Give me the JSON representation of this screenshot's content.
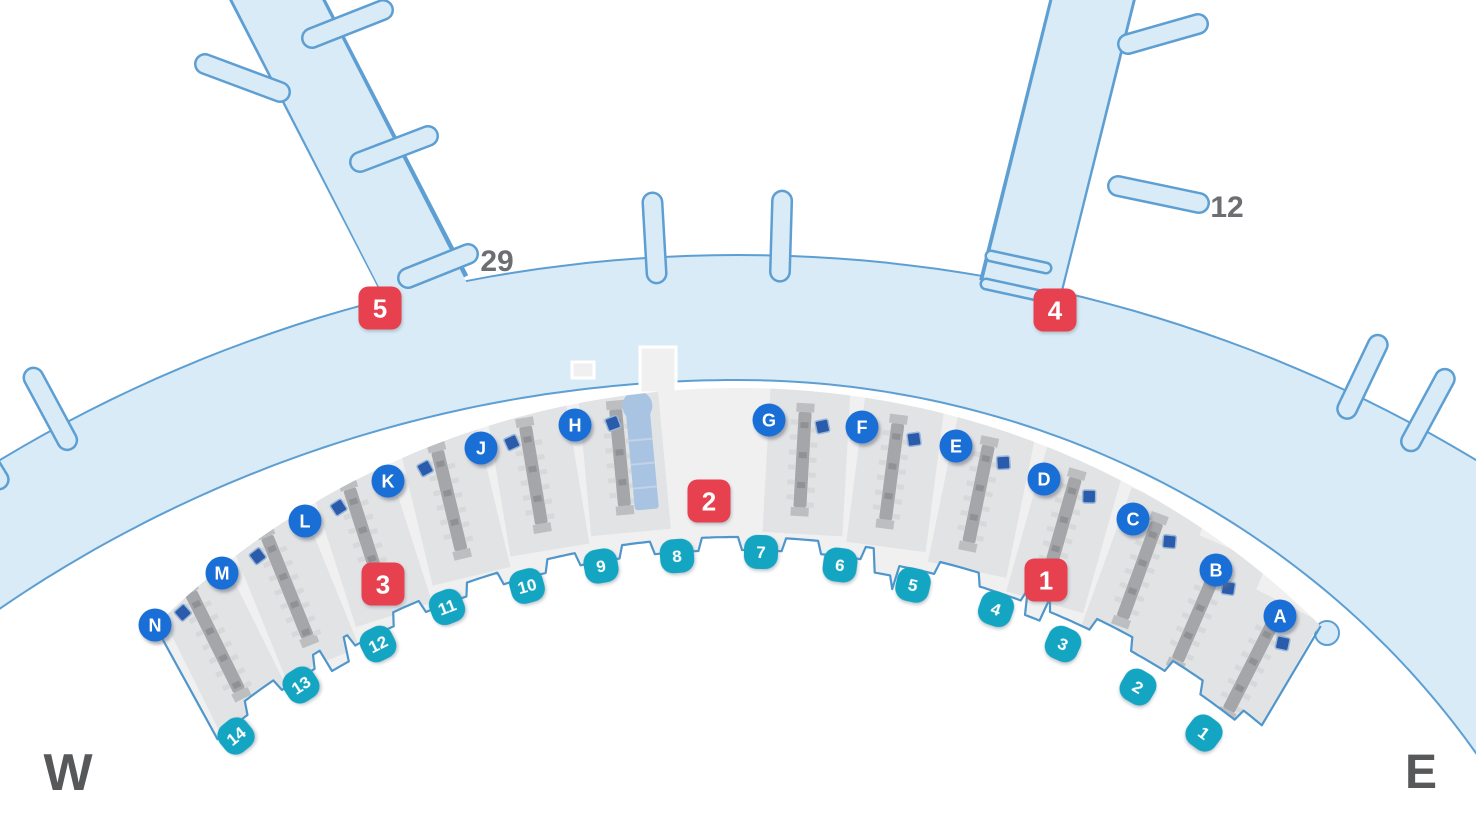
{
  "title": "Airport terminal level map",
  "compass": {
    "west": "W",
    "east": "E"
  },
  "pier_labels": [
    {
      "text": "29",
      "x": 497,
      "y": 271
    },
    {
      "text": "12",
      "x": 1227,
      "y": 217
    }
  ],
  "entrances": [
    {
      "label": "1",
      "x": 1046,
      "y": 580
    },
    {
      "label": "2",
      "x": 709,
      "y": 501
    },
    {
      "label": "3",
      "x": 383,
      "y": 584
    },
    {
      "label": "4",
      "x": 1055,
      "y": 310
    },
    {
      "label": "5",
      "x": 380,
      "y": 308
    }
  ],
  "checkin_counters": [
    {
      "letter": "A",
      "x": 1280,
      "y": 616,
      "theta": 26.9,
      "r": 1135,
      "h": 125
    },
    {
      "letter": "B",
      "x": 1216,
      "y": 570,
      "theta": 23.4,
      "r": 1160,
      "h": 128
    },
    {
      "letter": "C",
      "x": 1133,
      "y": 519,
      "theta": 20.0,
      "r": 1180,
      "h": 130
    },
    {
      "letter": "D",
      "x": 1044,
      "y": 479,
      "theta": 15.8,
      "r": 1198,
      "h": 128
    },
    {
      "letter": "E",
      "x": 956,
      "y": 446,
      "theta": 11.6,
      "r": 1210,
      "h": 126
    },
    {
      "letter": "F",
      "x": 862,
      "y": 427,
      "theta": 7.4,
      "r": 1218,
      "h": 124
    },
    {
      "letter": "G",
      "x": 769,
      "y": 420,
      "theta": 3.2,
      "r": 1222,
      "h": 122
    },
    {
      "letter": "H",
      "x": 575,
      "y": 425,
      "theta": -5.3,
      "r": 1228,
      "h": 124,
      "ramp": true
    },
    {
      "letter": "J",
      "x": 481,
      "y": 448,
      "theta": -9.4,
      "r": 1222,
      "h": 126
    },
    {
      "letter": "K",
      "x": 388,
      "y": 481,
      "theta": -13.5,
      "r": 1214,
      "h": 130
    },
    {
      "letter": "L",
      "x": 305,
      "y": 521,
      "theta": -17.8,
      "r": 1200,
      "h": 134
    },
    {
      "letter": "M",
      "x": 222,
      "y": 573,
      "theta": -22.1,
      "r": 1182,
      "h": 138
    },
    {
      "letter": "N",
      "x": 155,
      "y": 625,
      "theta": -26.4,
      "r": 1162,
      "h": 140
    }
  ],
  "doors": [
    {
      "label": "1",
      "x": 1204,
      "y": 733
    },
    {
      "label": "2",
      "x": 1138,
      "y": 687
    },
    {
      "label": "3",
      "x": 1063,
      "y": 644
    },
    {
      "label": "4",
      "x": 996,
      "y": 609
    },
    {
      "label": "5",
      "x": 913,
      "y": 585
    },
    {
      "label": "6",
      "x": 840,
      "y": 565
    },
    {
      "label": "7",
      "x": 761,
      "y": 552
    },
    {
      "label": "8",
      "x": 677,
      "y": 556
    },
    {
      "label": "9",
      "x": 601,
      "y": 566
    },
    {
      "label": "10",
      "x": 527,
      "y": 586
    },
    {
      "label": "11",
      "x": 447,
      "y": 607
    },
    {
      "label": "12",
      "x": 378,
      "y": 644
    },
    {
      "label": "13",
      "x": 301,
      "y": 685
    },
    {
      "label": "14",
      "x": 236,
      "y": 736
    }
  ],
  "colors": {
    "band_fill": "#d9ebf6",
    "band_stroke": "#5d9fd3",
    "building_fill": "#f0f0f1",
    "building_outline": "#4e96cb",
    "zone_fill": "#e2e3e5",
    "island_bar": "#a4a6a9",
    "island_tick": "#d7d8da",
    "island_dark": "#8f9194",
    "island_cap": "#bcbec0",
    "facility_blue": "#2b5cab",
    "facility_edge": "#9db7d8",
    "ramp_blue": "#a9c4e3",
    "ramp_line": "#c2d3e8",
    "gate_blue": "#1a6fd6",
    "door_teal": "#14a5c3",
    "entrance_red": "#e7404e",
    "label_gray": "#6d6e71",
    "compass_gray": "#57585a",
    "white": "#ffffff"
  }
}
